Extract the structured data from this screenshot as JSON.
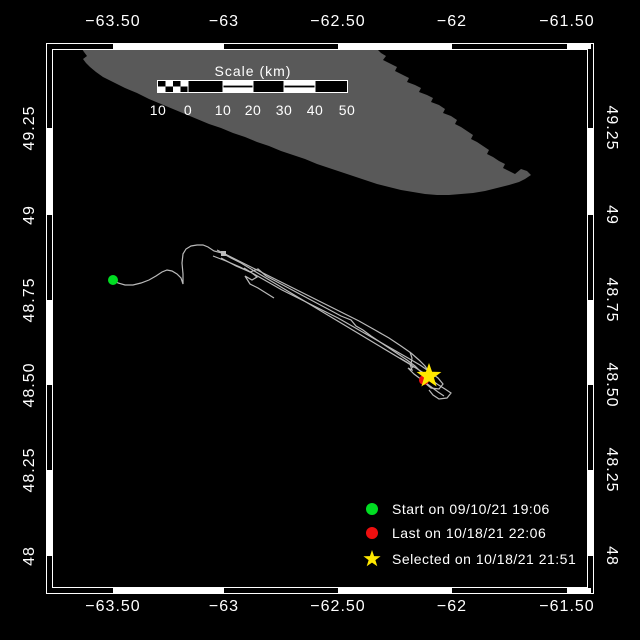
{
  "chart_data": {
    "type": "map",
    "title": "",
    "projection": "lon-lat (Mercator-style) track map",
    "xlabel": "longitude (degrees)",
    "ylabel": "latitude (degrees)",
    "lon_ticks": [
      -63.5,
      -63.0,
      -62.5,
      -62.0,
      -61.5
    ],
    "lat_ticks": [
      49.25,
      49.0,
      48.75,
      48.5,
      48.25,
      48.0
    ],
    "lon_range_approx": [
      -63.78,
      -61.4
    ],
    "lat_range_approx": [
      47.91,
      49.48
    ],
    "land": "gray landmass / island coastline occupying the upper portion of the map",
    "track": "light-gray drift track starting at a green dot near (-63.5, 48.81), rising to about (-63.08, 48.90), then descending southeast as a tight bundle of repeated passes to the star near (-62.1, 48.53)",
    "markers": [
      {
        "symbol": "green-circle",
        "label": "Start on 09/10/21 19:06",
        "lon_approx": -63.5,
        "lat_approx": 48.81
      },
      {
        "symbol": "red-circle",
        "label": "Last on 10/18/21 22:06",
        "lon_approx": -62.12,
        "lat_approx": 48.52
      },
      {
        "symbol": "yellow-star",
        "label": "Selected on 10/18/21 21:51",
        "lon_approx": -62.1,
        "lat_approx": 48.53
      }
    ],
    "scale_bar": {
      "title": "Scale (km)",
      "tick_labels": [
        10,
        0,
        10,
        20,
        30,
        40,
        50
      ]
    }
  },
  "colors": {
    "background": "#000000",
    "land": "#595959",
    "frame": "#ffffff",
    "track": "#bababa",
    "start_green": "#00dd22",
    "last_red": "#ee0f0f",
    "selected_yellow": "#ffe800",
    "text": "#ffffff"
  },
  "axis": {
    "top": {
      "y": 22,
      "items": [
        {
          "t": "−63.50",
          "x": 113
        },
        {
          "t": "−63",
          "x": 224
        },
        {
          "t": "−62.50",
          "x": 338
        },
        {
          "t": "−62",
          "x": 452
        },
        {
          "t": "−61.50",
          "x": 567
        }
      ]
    },
    "bottom": {
      "y": 607,
      "items": [
        {
          "t": "−63.50",
          "x": 113
        },
        {
          "t": "−63",
          "x": 224
        },
        {
          "t": "−62.50",
          "x": 338
        },
        {
          "t": "−62",
          "x": 452
        },
        {
          "t": "−61.50",
          "x": 567
        }
      ]
    },
    "left": {
      "x": 30,
      "items": [
        {
          "t": "49.25",
          "y": 128
        },
        {
          "t": "49",
          "y": 215
        },
        {
          "t": "48.75",
          "y": 300
        },
        {
          "t": "48.50",
          "y": 385
        },
        {
          "t": "48.25",
          "y": 470
        },
        {
          "t": "48",
          "y": 556
        }
      ]
    },
    "right": {
      "x": 611,
      "items": [
        {
          "t": "49.25",
          "y": 128
        },
        {
          "t": "49",
          "y": 215
        },
        {
          "t": "48.75",
          "y": 300
        },
        {
          "t": "48.50",
          "y": 385
        },
        {
          "t": "48.25",
          "y": 470
        },
        {
          "t": "48",
          "y": 556
        }
      ]
    }
  },
  "frame": {
    "outer": [
      46,
      43,
      547,
      550
    ],
    "inner": [
      52,
      49,
      535,
      538
    ],
    "band_thick": 5,
    "white_x_segments": [
      [
        113,
        224
      ],
      [
        338,
        452
      ],
      [
        567,
        591
      ]
    ],
    "white_y_segments": [
      [
        128,
        215
      ],
      [
        300,
        385
      ],
      [
        470,
        556
      ]
    ]
  },
  "scalebar": {
    "title": "Scale (km)",
    "title_x": 253,
    "title_y": 71,
    "labels_y": 110,
    "labels": [
      {
        "t": "10",
        "x": 158
      },
      {
        "t": "0",
        "x": 188
      },
      {
        "t": "10",
        "x": 223
      },
      {
        "t": "20",
        "x": 253
      },
      {
        "t": "30",
        "x": 284
      },
      {
        "t": "40",
        "x": 315
      },
      {
        "t": "50",
        "x": 347
      }
    ],
    "outline": [
      157,
      80,
      191,
      13
    ],
    "rects": [
      {
        "x": 158.0,
        "y": 81,
        "w": 7.5,
        "h": 5.5,
        "f": "#000000"
      },
      {
        "x": 165.5,
        "y": 81,
        "w": 7.5,
        "h": 5.5,
        "f": "#ffffff"
      },
      {
        "x": 173.0,
        "y": 81,
        "w": 7.5,
        "h": 5.5,
        "f": "#000000"
      },
      {
        "x": 180.5,
        "y": 81,
        "w": 7.5,
        "h": 5.5,
        "f": "#ffffff"
      },
      {
        "x": 158.0,
        "y": 86.5,
        "w": 7.5,
        "h": 5.5,
        "f": "#ffffff"
      },
      {
        "x": 165.5,
        "y": 86.5,
        "w": 7.5,
        "h": 5.5,
        "f": "#000000"
      },
      {
        "x": 173.0,
        "y": 86.5,
        "w": 7.5,
        "h": 5.5,
        "f": "#ffffff"
      },
      {
        "x": 180.5,
        "y": 86.5,
        "w": 7.5,
        "h": 5.5,
        "f": "#000000"
      },
      {
        "x": 188,
        "y": 81,
        "w": 35,
        "h": 11,
        "f": "#000000"
      },
      {
        "x": 223,
        "y": 81,
        "w": 30,
        "h": 11,
        "f": "#ffffff"
      },
      {
        "x": 223,
        "y": 85.6,
        "w": 30,
        "h": 1.8,
        "f": "#000000"
      },
      {
        "x": 253,
        "y": 81,
        "w": 31,
        "h": 11,
        "f": "#000000"
      },
      {
        "x": 284,
        "y": 81,
        "w": 31,
        "h": 11,
        "f": "#ffffff"
      },
      {
        "x": 284,
        "y": 85.6,
        "w": 31,
        "h": 1.8,
        "f": "#000000"
      },
      {
        "x": 315,
        "y": 81,
        "w": 32,
        "h": 11,
        "f": "#000000"
      },
      {
        "x": 187.5,
        "y": 81,
        "w": 1,
        "h": 11,
        "f": "#ffffff"
      },
      {
        "x": 222.5,
        "y": 81,
        "w": 1,
        "h": 11,
        "f": "#ffffff"
      },
      {
        "x": 252.5,
        "y": 81,
        "w": 1,
        "h": 11,
        "f": "#ffffff"
      },
      {
        "x": 283.5,
        "y": 81,
        "w": 1,
        "h": 11,
        "f": "#ffffff"
      },
      {
        "x": 314.5,
        "y": 81,
        "w": 1,
        "h": 11,
        "f": "#ffffff"
      }
    ]
  },
  "land_polygon": [
    [
      82,
      49
    ],
    [
      377,
      49
    ],
    [
      381,
      53
    ],
    [
      386,
      56
    ],
    [
      383,
      60
    ],
    [
      391,
      64
    ],
    [
      397,
      67
    ],
    [
      395,
      71
    ],
    [
      403,
      75
    ],
    [
      409,
      78
    ],
    [
      407,
      82
    ],
    [
      415,
      85
    ],
    [
      421,
      88
    ],
    [
      419,
      92
    ],
    [
      427,
      95
    ],
    [
      433,
      98
    ],
    [
      431,
      102
    ],
    [
      439,
      105
    ],
    [
      445,
      109
    ],
    [
      443,
      113
    ],
    [
      451,
      116
    ],
    [
      457,
      120
    ],
    [
      455,
      124
    ],
    [
      461,
      127
    ],
    [
      467,
      131
    ],
    [
      473,
      135
    ],
    [
      471,
      139
    ],
    [
      477,
      142
    ],
    [
      483,
      146
    ],
    [
      489,
      150
    ],
    [
      487,
      154
    ],
    [
      493,
      157
    ],
    [
      499,
      161
    ],
    [
      505,
      164
    ],
    [
      503,
      168
    ],
    [
      509,
      171
    ],
    [
      515,
      174
    ],
    [
      521,
      169
    ],
    [
      527,
      171
    ],
    [
      531,
      175
    ],
    [
      525,
      179
    ],
    [
      519,
      182
    ],
    [
      509,
      185
    ],
    [
      497,
      188
    ],
    [
      485,
      191
    ],
    [
      473,
      193
    ],
    [
      461,
      194
    ],
    [
      449,
      195
    ],
    [
      437,
      195
    ],
    [
      425,
      194
    ],
    [
      413,
      192
    ],
    [
      401,
      190
    ],
    [
      389,
      187
    ],
    [
      377,
      184
    ],
    [
      365,
      180
    ],
    [
      353,
      176
    ],
    [
      341,
      172
    ],
    [
      329,
      168
    ],
    [
      317,
      164
    ],
    [
      305,
      159
    ],
    [
      293,
      155
    ],
    [
      281,
      151
    ],
    [
      269,
      146
    ],
    [
      257,
      142
    ],
    [
      245,
      137
    ],
    [
      233,
      133
    ],
    [
      221,
      128
    ],
    [
      209,
      124
    ],
    [
      197,
      119
    ],
    [
      185,
      114
    ],
    [
      173,
      109
    ],
    [
      161,
      104
    ],
    [
      149,
      99
    ],
    [
      137,
      93
    ],
    [
      125,
      88
    ],
    [
      113,
      82
    ],
    [
      103,
      77
    ],
    [
      96,
      72
    ],
    [
      90,
      67
    ],
    [
      86,
      63
    ],
    [
      83,
      59
    ],
    [
      87,
      56
    ],
    [
      84,
      52
    ]
  ],
  "track": {
    "square_marker": [
      221,
      251,
      5,
      5
    ],
    "strands": [
      [
        [
          113,
          280
        ],
        [
          118,
          283
        ],
        [
          125,
          285
        ],
        [
          133,
          285
        ],
        [
          141,
          283
        ],
        [
          149,
          280
        ],
        [
          156,
          276
        ],
        [
          162,
          272
        ],
        [
          167,
          270
        ],
        [
          172,
          271
        ],
        [
          177,
          274
        ],
        [
          181,
          278
        ],
        [
          183,
          284
        ],
        [
          183,
          274
        ],
        [
          182,
          263
        ],
        [
          183,
          254
        ],
        [
          186,
          249
        ],
        [
          191,
          246
        ],
        [
          197,
          245
        ],
        [
          203,
          245
        ],
        [
          208,
          247
        ],
        [
          214,
          251
        ],
        [
          222,
          253
        ],
        [
          231,
          258
        ],
        [
          241,
          263
        ],
        [
          251,
          269
        ],
        [
          261,
          275
        ],
        [
          271,
          281
        ],
        [
          281,
          287
        ],
        [
          291,
          293
        ],
        [
          301,
          299
        ],
        [
          311,
          305
        ],
        [
          321,
          311
        ],
        [
          331,
          317
        ],
        [
          341,
          323
        ],
        [
          351,
          329
        ],
        [
          361,
          335
        ],
        [
          371,
          341
        ],
        [
          381,
          347
        ],
        [
          391,
          353
        ],
        [
          401,
          359
        ],
        [
          411,
          365
        ],
        [
          419,
          370
        ],
        [
          427,
          375
        ],
        [
          432,
          379
        ]
      ],
      [
        [
          213,
          256
        ],
        [
          226,
          261
        ],
        [
          240,
          267
        ],
        [
          254,
          274
        ],
        [
          268,
          282
        ],
        [
          282,
          290
        ],
        [
          296,
          297
        ],
        [
          310,
          304
        ],
        [
          324,
          311
        ],
        [
          338,
          318
        ],
        [
          352,
          326
        ],
        [
          366,
          334
        ],
        [
          380,
          342
        ],
        [
          394,
          350
        ],
        [
          408,
          358
        ],
        [
          420,
          365
        ],
        [
          430,
          372
        ],
        [
          438,
          378
        ],
        [
          443,
          384
        ],
        [
          439,
          389
        ],
        [
          431,
          388
        ],
        [
          425,
          383
        ]
      ],
      [
        [
          217,
          250
        ],
        [
          231,
          257
        ],
        [
          247,
          265
        ],
        [
          263,
          273
        ],
        [
          279,
          281
        ],
        [
          295,
          289
        ],
        [
          311,
          297
        ],
        [
          327,
          305
        ],
        [
          343,
          313
        ],
        [
          359,
          321
        ],
        [
          375,
          330
        ],
        [
          389,
          338
        ],
        [
          401,
          346
        ],
        [
          411,
          353
        ],
        [
          419,
          360
        ],
        [
          425,
          366
        ],
        [
          429,
          372
        ]
      ],
      [
        [
          221,
          258
        ],
        [
          236,
          266
        ],
        [
          250,
          272
        ],
        [
          258,
          269
        ],
        [
          266,
          276
        ],
        [
          281,
          284
        ],
        [
          296,
          292
        ],
        [
          311,
          300
        ],
        [
          326,
          308
        ],
        [
          341,
          316
        ],
        [
          351,
          320
        ],
        [
          356,
          326
        ],
        [
          363,
          330
        ],
        [
          371,
          336
        ],
        [
          383,
          344
        ],
        [
          395,
          352
        ],
        [
          407,
          360
        ],
        [
          415,
          366
        ],
        [
          421,
          372
        ],
        [
          429,
          378
        ],
        [
          437,
          384
        ],
        [
          445,
          389
        ],
        [
          451,
          393
        ],
        [
          447,
          398
        ],
        [
          439,
          399
        ],
        [
          433,
          395
        ],
        [
          429,
          390
        ]
      ],
      [
        [
          400,
          358
        ],
        [
          410,
          364
        ],
        [
          412,
          370
        ],
        [
          408,
          368
        ],
        [
          414,
          374
        ],
        [
          422,
          380
        ],
        [
          430,
          386
        ],
        [
          438,
          392
        ],
        [
          444,
          396
        ]
      ],
      [
        [
          244,
          268
        ],
        [
          252,
          273
        ],
        [
          257,
          277
        ],
        [
          252,
          280
        ],
        [
          245,
          276
        ],
        [
          250,
          284
        ],
        [
          258,
          288
        ],
        [
          266,
          293
        ],
        [
          274,
          298
        ]
      ],
      [
        [
          410,
          352
        ],
        [
          412,
          358
        ],
        [
          411,
          364
        ],
        [
          413,
          368
        ]
      ]
    ]
  },
  "markers": {
    "start": {
      "x": 113,
      "y": 280,
      "r": 5
    },
    "last": {
      "x": 424,
      "y": 380,
      "r": 5
    },
    "selected": {
      "x": 429,
      "y": 376,
      "ro": 13,
      "ri": 5.2
    }
  },
  "legend": {
    "marker_x": 372,
    "text_x": 392,
    "rows": [
      {
        "type": "circle",
        "color_key": "start_green",
        "y": 509,
        "label": "Start on 09/10/21 19:06"
      },
      {
        "type": "circle",
        "color_key": "last_red",
        "y": 533,
        "label": "Last on 10/18/21 22:06"
      },
      {
        "type": "star",
        "color_key": "selected_yellow",
        "y": 559,
        "label": "Selected on 10/18/21 21:51"
      }
    ]
  }
}
